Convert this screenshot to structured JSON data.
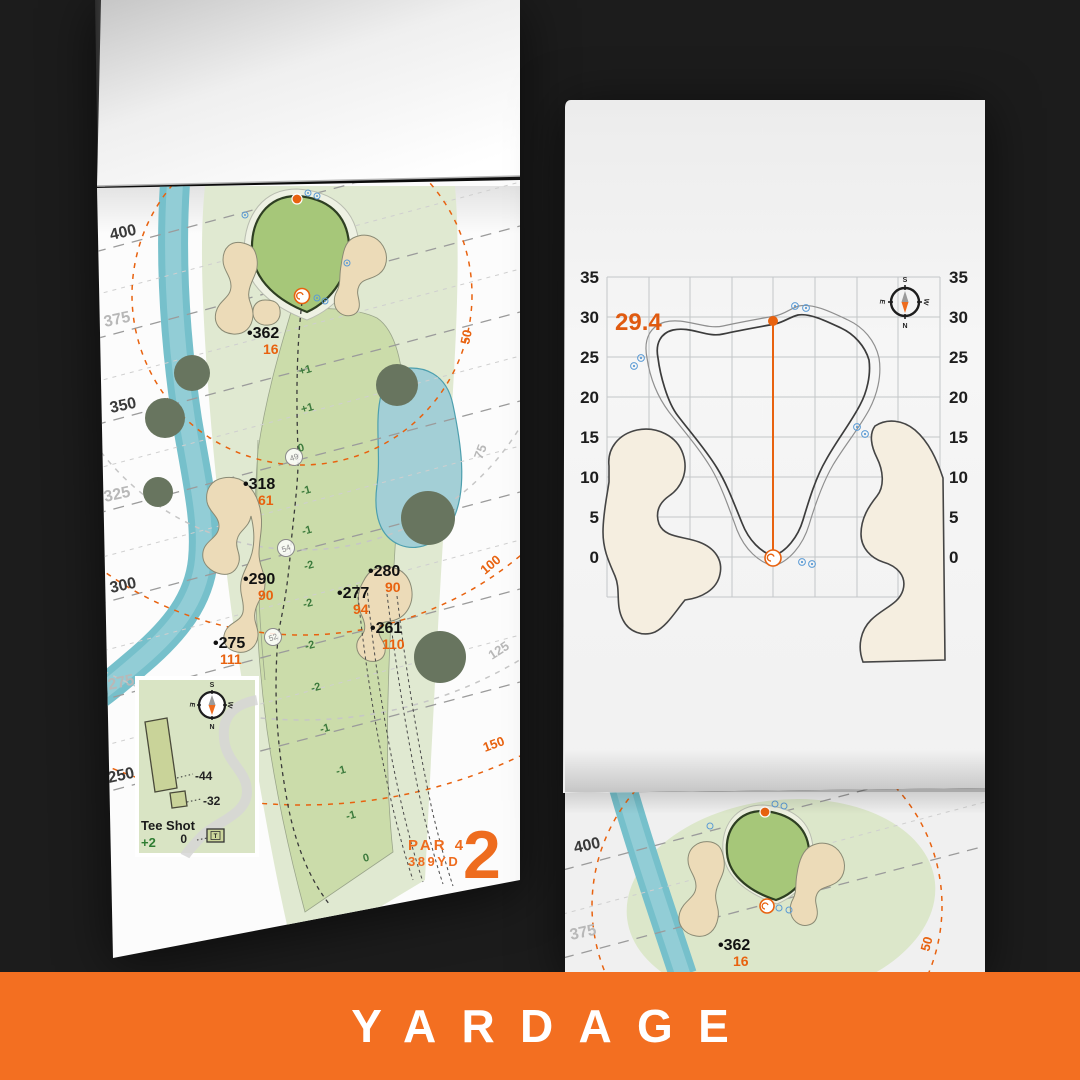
{
  "banner": {
    "label": "YARDAGE",
    "bg": "#f36f21"
  },
  "colors": {
    "accent_orange": "#e8620f",
    "banner_orange": "#f36f21",
    "water": "#76c0cb",
    "fairway": "#cbdcaa",
    "rough": "#e0e9d1",
    "green": "#a6c779",
    "sand": "#ecdbb8"
  },
  "left_page": {
    "hole": {
      "number": "2",
      "par": "PAR 4",
      "yards": "389YD"
    },
    "distance_labels": [
      "400",
      "375",
      "350",
      "325",
      "300",
      "275",
      "250"
    ],
    "arc_labels": [
      "50",
      "75",
      "100",
      "125",
      "150"
    ],
    "markers": [
      {
        "dist": "•362",
        "carry": "16"
      },
      {
        "dist": "•318",
        "carry": "61"
      },
      {
        "dist": "•290",
        "carry": "90"
      },
      {
        "dist": "•280",
        "carry": "90"
      },
      {
        "dist": "•277",
        "carry": "94"
      },
      {
        "dist": "•261",
        "carry": "110"
      },
      {
        "dist": "•275",
        "carry": "111"
      }
    ],
    "centerline_nodes": [
      "49",
      "54",
      "52"
    ],
    "elevations": [
      "+1",
      "+1",
      "0",
      "-1",
      "-1",
      "-2",
      "-2",
      "-2",
      "-2",
      "-1",
      "-1",
      "-1",
      "0"
    ],
    "inset": {
      "title": "Tee Shot",
      "score": "+2",
      "back_tee_offset": "-44",
      "front_tee_offset": "-32",
      "zero": "0",
      "tee_icon": "T"
    }
  },
  "right_page": {
    "green_chart": {
      "pin_depth_label": "29.4",
      "axis_ticks": [
        "35",
        "30",
        "25",
        "20",
        "15",
        "10",
        "5",
        "0"
      ]
    }
  },
  "next_page": {
    "distance_labels": [
      "400",
      "375"
    ],
    "marker": {
      "dist": "•362",
      "carry": "16"
    },
    "arc_label": "50"
  },
  "compass": {
    "n": "N",
    "s": "S",
    "e": "E",
    "w": "W"
  },
  "chart_data": {
    "type": "line",
    "title": "Green depth grid (hole 2)",
    "y_ticks": [
      35,
      30,
      25,
      20,
      15,
      10,
      5,
      0
    ],
    "pin_depth": 29.4,
    "units": "yd",
    "grid": "on"
  }
}
